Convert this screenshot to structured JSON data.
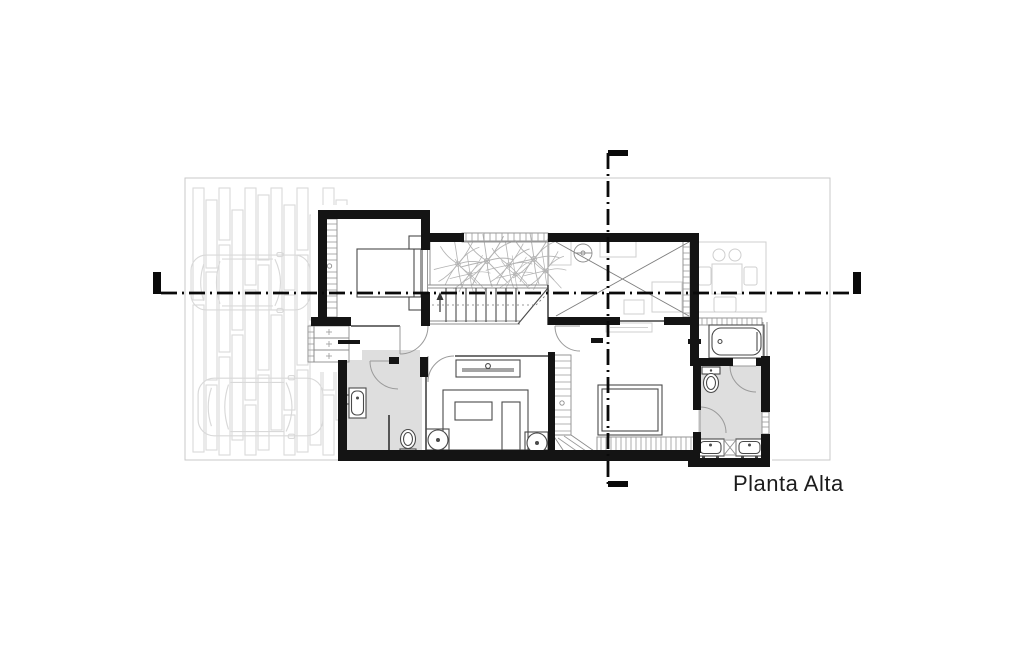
{
  "plan": {
    "label": "Planta Alta"
  },
  "colors": {
    "wall": "#141414",
    "thin": "#444444",
    "fixture": "#4a4a4a",
    "faint": "#d9d9d9",
    "floor": "#dedede",
    "hatch": "#9a9a9a",
    "plants": "#b3b3b3",
    "lot": "#c9c9c9",
    "section": "#0a0a0a",
    "label": "#1c1c1c",
    "bg": "#ffffff"
  },
  "features": [
    "lot-boundary",
    "garage-slat-deck",
    "car-top-view",
    "bedroom-1",
    "closet-hatch",
    "shelf-closet",
    "planter-plants",
    "stairs",
    "stairs-direction-arrow",
    "double-height-void-cross",
    "ceiling-fan",
    "hallway-console",
    "bathroom-2",
    "sink",
    "toilet",
    "bedroom-2",
    "bed",
    "round-nightstand",
    "wardrobe-hatch",
    "deck-hatch-strip",
    "master-bedroom",
    "master-bathroom",
    "bathtub",
    "double-sink",
    "section-cut-line-horizontal",
    "section-cut-line-vertical",
    "section-cut-markers",
    "plan-title"
  ]
}
